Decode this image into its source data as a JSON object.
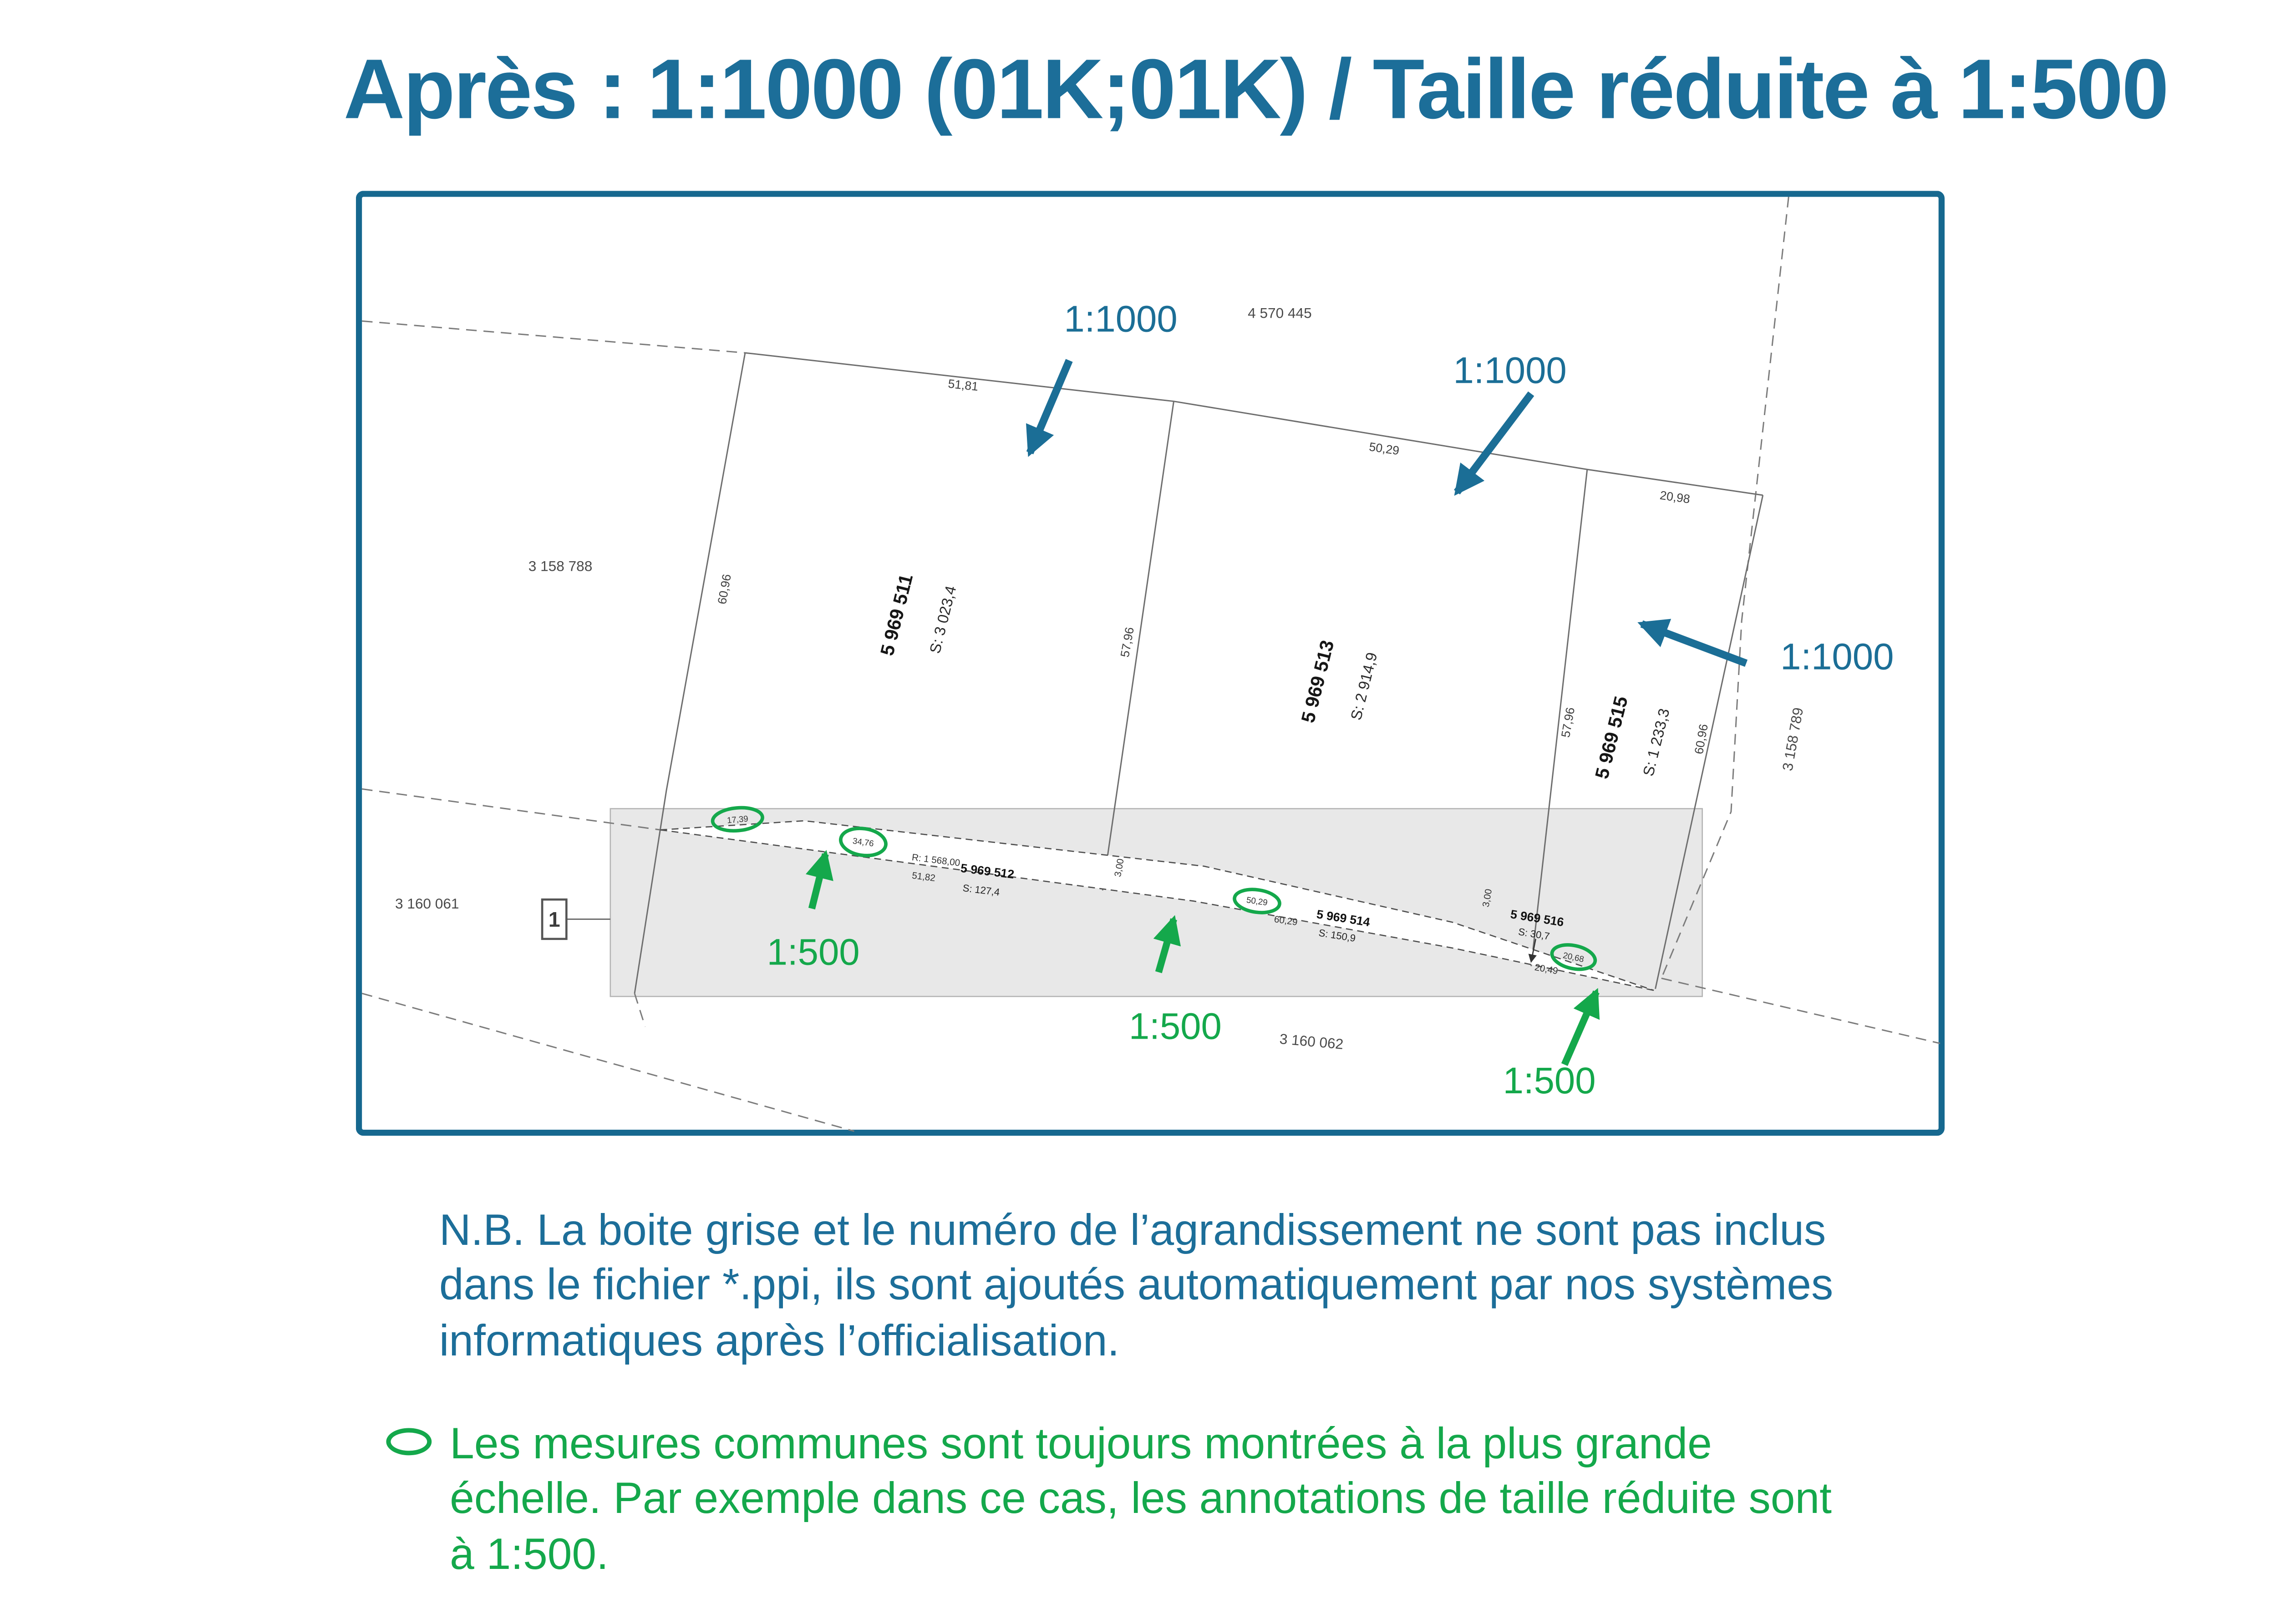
{
  "title": "Après : 1:1000 (01K;01K) / Taille réduite à 1:500",
  "colors": {
    "accent_teal": "#1C6E99",
    "border_teal": "#16688F",
    "green": "#14A84B",
    "gray_box": "#E8E8E8"
  },
  "map": {
    "scale_annotations": {
      "s1000": "1:1000",
      "s500": "1:500"
    },
    "inset_marker": "1",
    "lots": [
      {
        "id": "5 969 511",
        "area": "S: 3 023,4"
      },
      {
        "id": "5 969 512",
        "area": "S: 127,4"
      },
      {
        "id": "5 969 513",
        "area": "S: 2 914,9"
      },
      {
        "id": "5 969 514",
        "area": "S: 150,9"
      },
      {
        "id": "5 969 515",
        "area": "S: 1 233,3"
      },
      {
        "id": "5 969 516",
        "area": "S: 30,7"
      }
    ],
    "parcels": {
      "p445": "4 570 445",
      "p788": "3 158 788",
      "p789": "3 158 789",
      "p061": "3 160 061",
      "p062": "3 160 062"
    },
    "measures": {
      "top1": "51,81",
      "top2": "50,29",
      "top3": "20,98",
      "m6096": "60,96",
      "m5796": "57,96"
    },
    "strip": {
      "m1739": "17,39",
      "m3476": "34,76",
      "r1568": "R: 1 568,00",
      "m5182": "51,82",
      "w300": "3,00",
      "m5029": "50,29",
      "m6029": "60,29",
      "m2068": "20,68",
      "m2049": "20,49"
    }
  },
  "notes": {
    "nb_lines": [
      "N.B. La boite grise et le numéro de l’agrandissement ne sont pas inclus",
      "dans le fichier *.ppi, ils sont ajoutés automatiquement par nos systèmes",
      "informatiques après l’officialisation."
    ],
    "bullet_lines": [
      "Les mesures communes sont toujours montrées à la plus grande",
      "échelle.  Par exemple dans ce cas, les annotations de taille réduite sont",
      "à 1:500."
    ]
  }
}
